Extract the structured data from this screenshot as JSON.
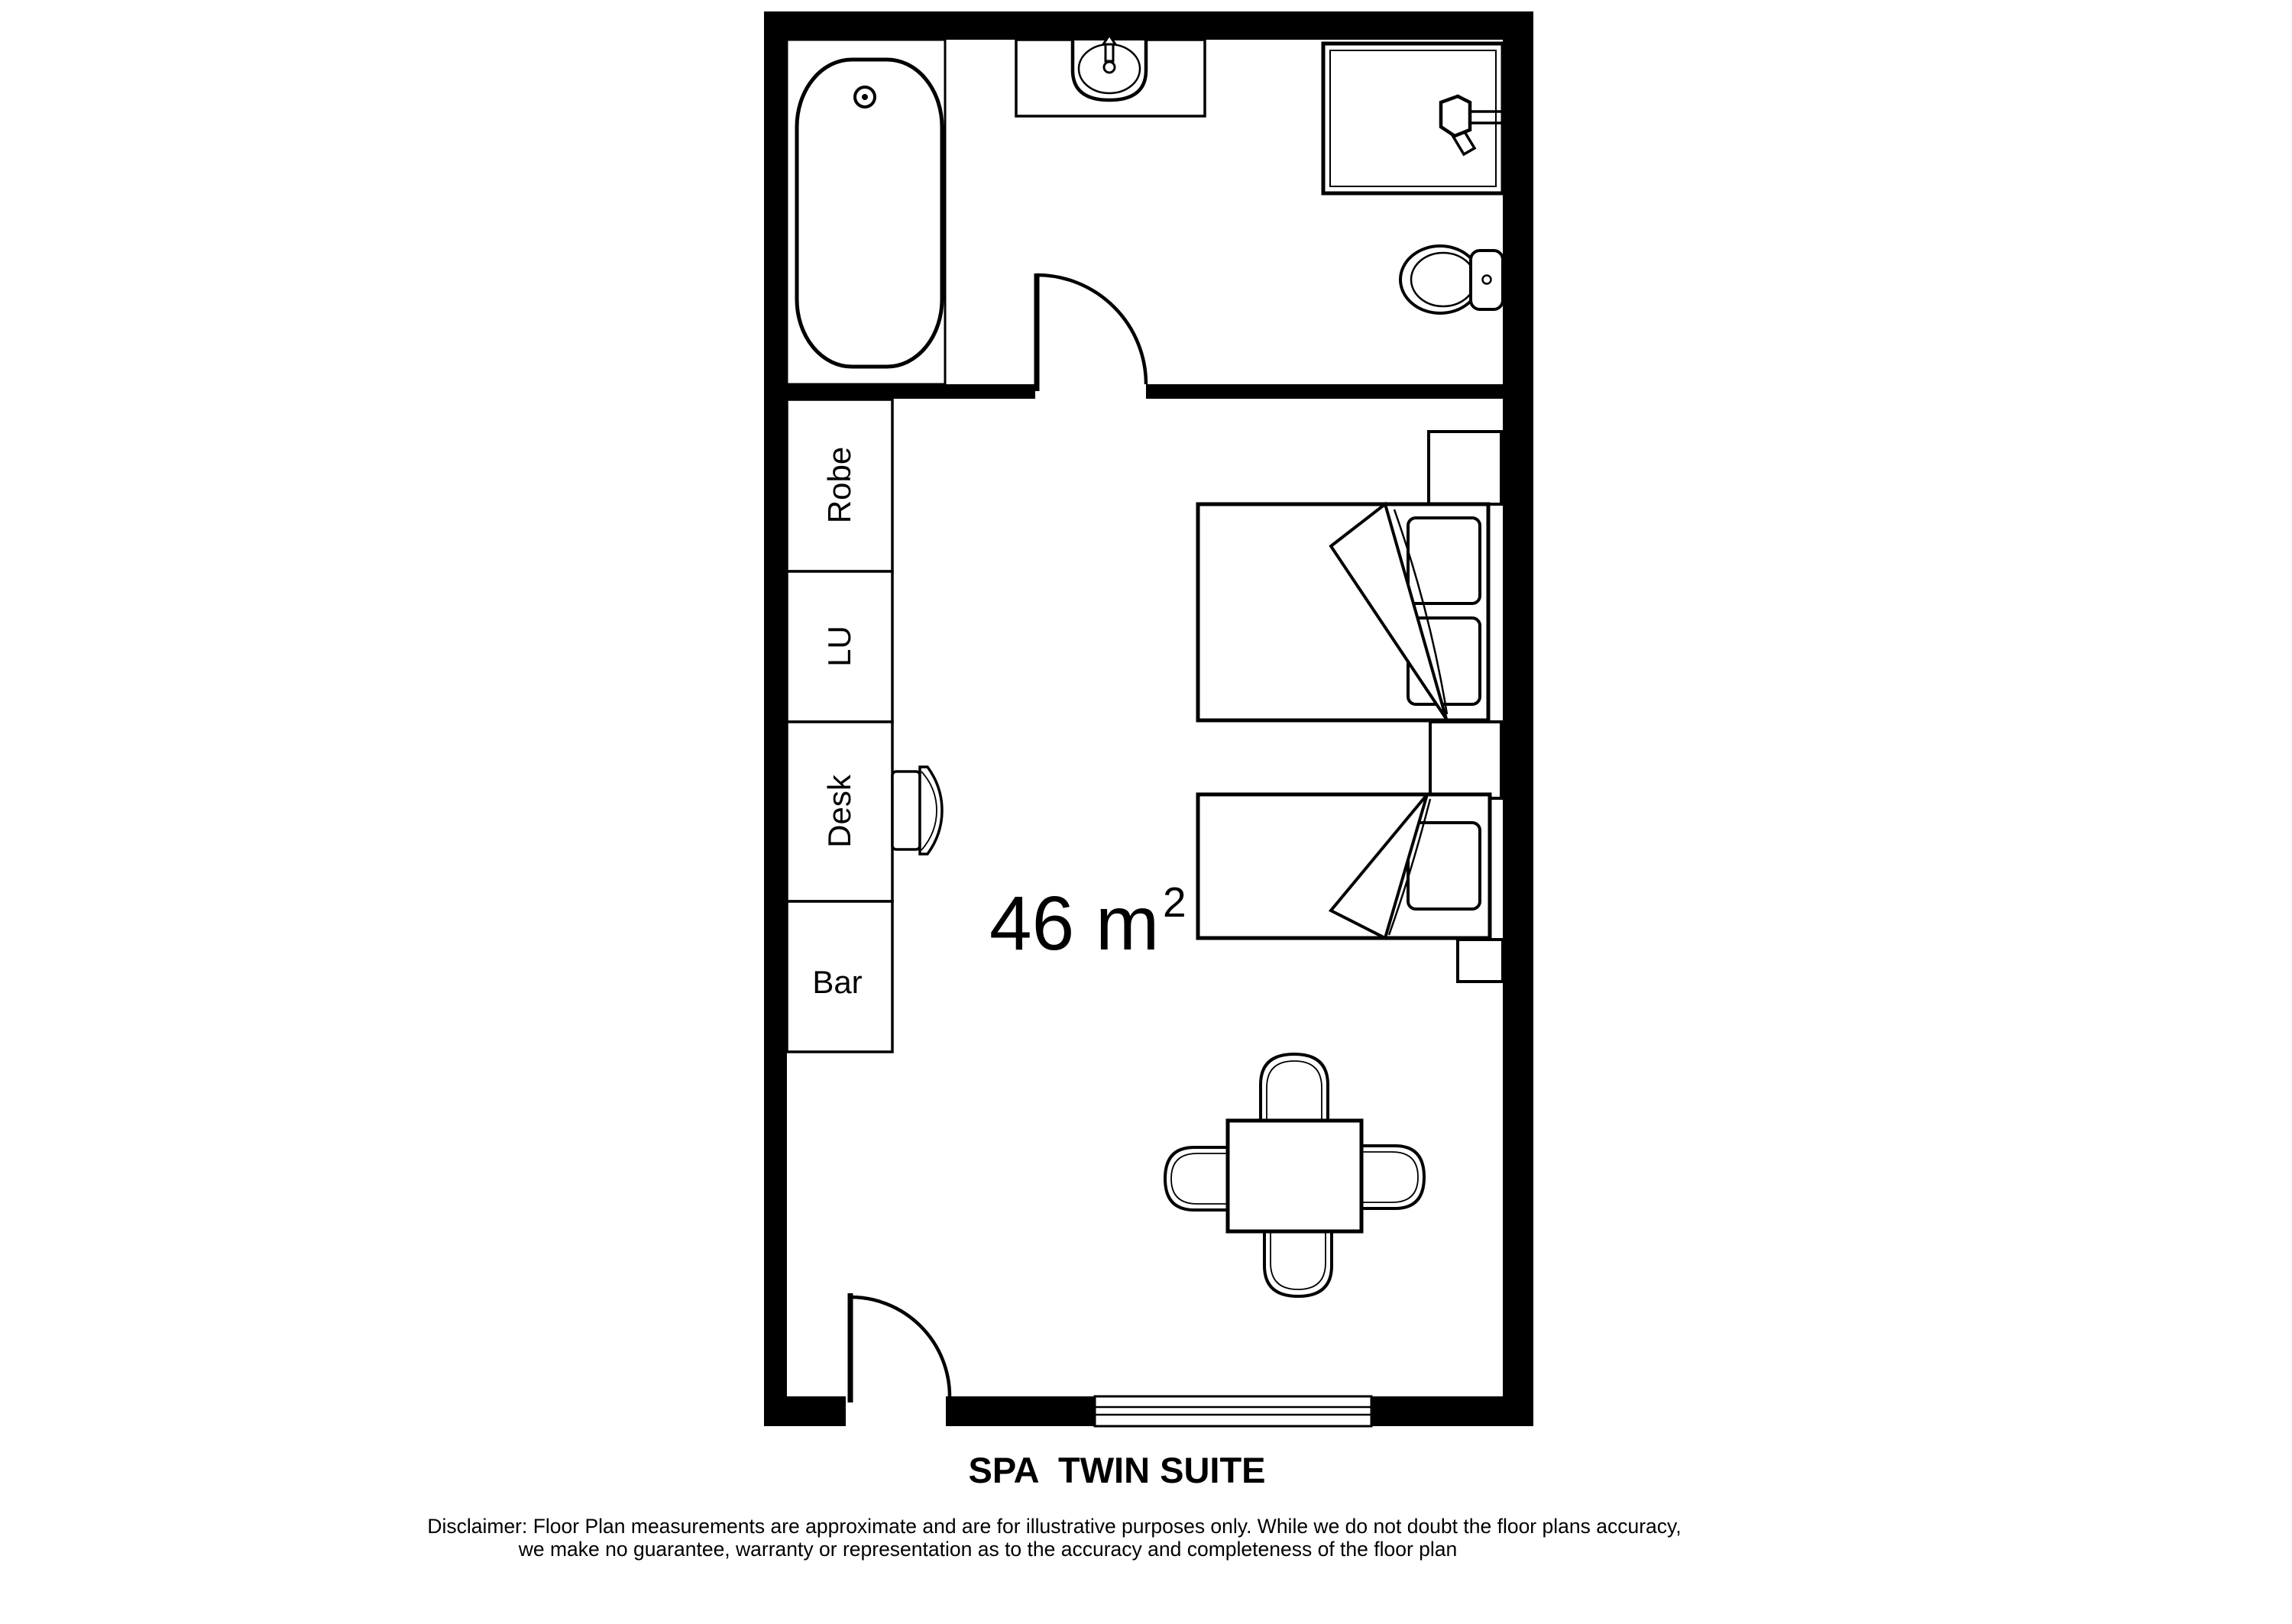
{
  "colors": {
    "background": "#ffffff",
    "line": "#000000",
    "wall": "#000000"
  },
  "plan": {
    "title": "SPA  TWIN SUITE",
    "area_label": {
      "main": "46 m",
      "exponent": "2"
    },
    "storage_labels": {
      "robe": "Robe",
      "lu": "LU",
      "desk": "Desk",
      "bar": "Bar"
    },
    "fixtures": [
      "bathtub",
      "bathtub-drain",
      "vanity-sink",
      "faucet",
      "shower",
      "shower-head",
      "toilet",
      "bathroom-door",
      "entry-door",
      "window",
      "robe-unit",
      "luggage-unit",
      "desk-unit",
      "bar-unit",
      "desk-chair",
      "double-bed",
      "single-bed",
      "pillow",
      "blanket-fold",
      "nightstand",
      "dining-table",
      "dining-chair"
    ]
  },
  "disclaimer": {
    "line1": "Disclaimer: Floor Plan measurements are approximate and are for illustrative purposes only. While we do not doubt the floor plans accuracy,",
    "line2": "we make no guarantee, warranty or representation as to the accuracy and completeness of the floor plan"
  }
}
